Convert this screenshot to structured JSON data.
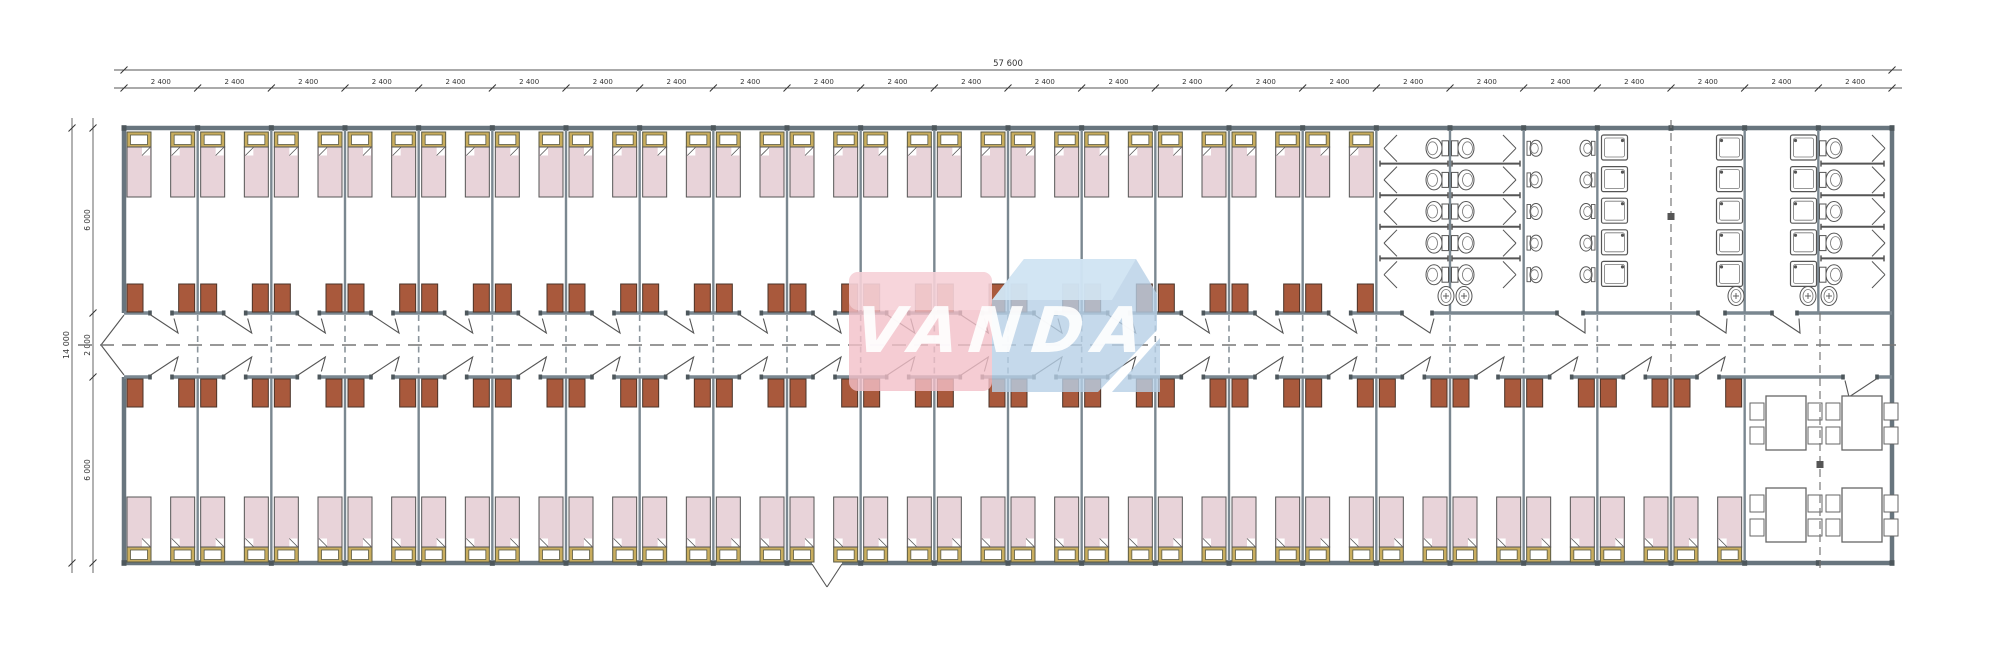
{
  "document": {
    "type": "architectural-floor-plan",
    "subject": "dormitory-module-plan"
  },
  "logo": {
    "text": "VANDA",
    "red": "#f2bfc8",
    "red_top": "#f8dde2",
    "blue": "#b7cfe6",
    "blue_top": "#d4e6f4",
    "text_color": "#ffffff"
  },
  "dimensions": {
    "total_width_label": "57 600",
    "bay_label": "2 400",
    "bay_count": 24,
    "total_depth_label": "14 000",
    "depth_segments": [
      "6 000",
      "2 000",
      "6 000"
    ]
  },
  "rooms": {
    "top_bedrooms": 17,
    "bottom_bedrooms": 22,
    "beds_per_room": 2,
    "wardrobes_per_room": 2,
    "sanitary": [
      {
        "name": "wc-room",
        "toilet_stalls": 10,
        "washbasins": 2
      },
      {
        "name": "urinal-room",
        "urinals": 10
      },
      {
        "name": "shower-room",
        "showers": 10,
        "washbasins": 1
      },
      {
        "name": "shower-wc-room",
        "showers": 5,
        "toilet_stalls": 5,
        "washbasins": 2
      }
    ],
    "dining": {
      "tables": 4,
      "chairs_per_table": 4
    },
    "fixture_rows": 5
  },
  "colors": {
    "ext_wall": "#68757e",
    "inner_wall": "#7a8790",
    "joint": "#4d575c",
    "bed_mattress": "#e8d3d9",
    "bed_frame": "#c9ad5e",
    "bed_frame_edge": "#5a5a44",
    "wardrobe": "#a9593c",
    "wardrobe_edge": "#4a3328",
    "fixture": "#555555",
    "dim_line": "#555555",
    "dim_text": "#333333",
    "dashed": "#777777"
  }
}
